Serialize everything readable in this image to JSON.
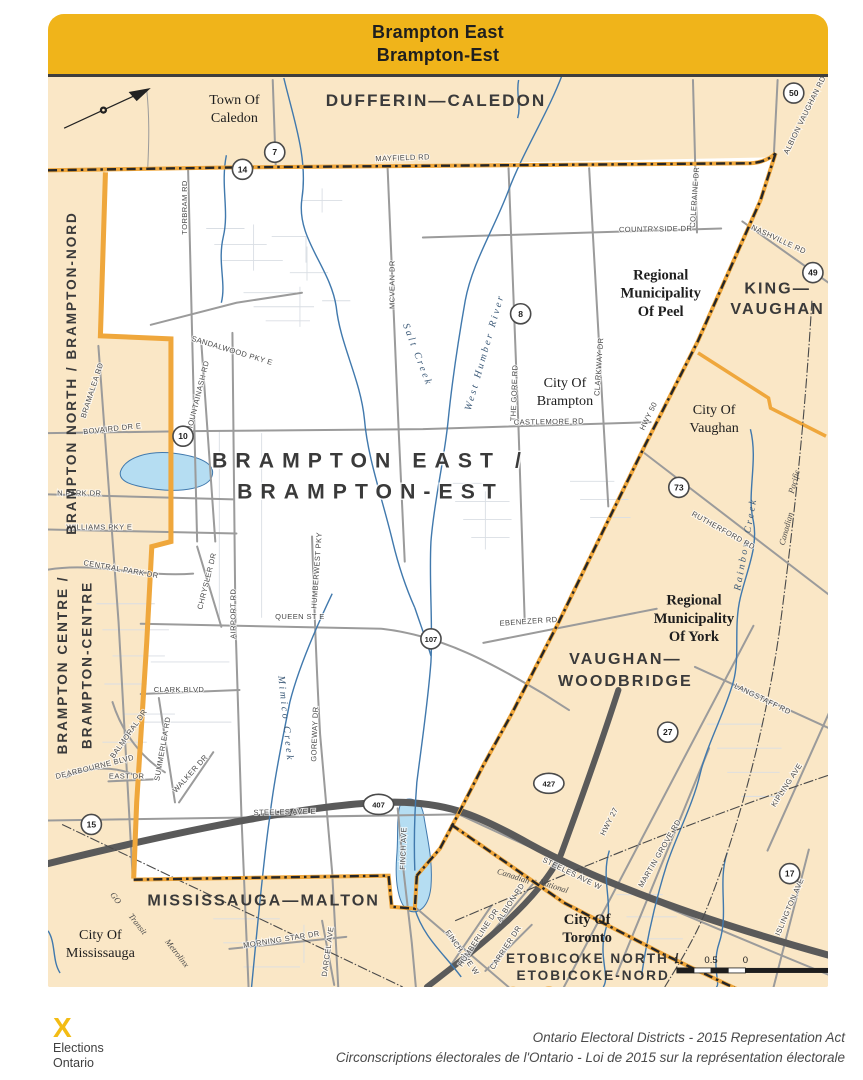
{
  "banner": {
    "line1": "Brampton East",
    "line2": "Brampton-Est"
  },
  "colors": {
    "banner_gold": "#F0B41A",
    "district_fill": "#FFFFFF",
    "neighbor_fill": "#FAE7C6",
    "boundary_yellow": "#EFA73C",
    "boundary_dash": "#262626",
    "water_blue": "#4179AD",
    "lake_fill": "#B5DDF2",
    "highway_gray": "#5A5A5A",
    "road_gray": "#9B9B9B"
  },
  "labels": {
    "central_district": [
      {
        "t": "BRAMPTON EAST /",
        "x": 368,
        "y": 466
      },
      {
        "t": "BRAMPTON-EST",
        "x": 368,
        "y": 497
      }
    ],
    "adjacent_districts": [
      {
        "t": "DUFFERIN—CALEDON",
        "x": 433,
        "y": 106,
        "s": 17
      },
      {
        "t": "KING—",
        "x": 772,
        "y": 293,
        "s": 16
      },
      {
        "t": "VAUGHAN",
        "x": 772,
        "y": 313,
        "s": 16
      },
      {
        "t": "VAUGHAN—",
        "x": 621,
        "y": 662,
        "s": 16
      },
      {
        "t": "WOODBRIDGE",
        "x": 621,
        "y": 684,
        "s": 16
      },
      {
        "t": "MISSISSAUGA—MALTON",
        "x": 262,
        "y": 903,
        "s": 16
      },
      {
        "t": "ETOBICOKE NORTH /",
        "x": 589,
        "y": 960,
        "s": 13.5
      },
      {
        "t": "ETOBICOKE-NORD",
        "x": 589,
        "y": 977,
        "s": 13.5
      },
      {
        "t": "BRAMPTON NORTH / BRAMPTON-NORD",
        "x": 76,
        "y": 372,
        "r": -90,
        "s": 13.5
      },
      {
        "t": "BRAMPTON CENTRE /",
        "x": 67,
        "y": 663,
        "r": -90,
        "s": 13.5
      },
      {
        "t": "BRAMPTON-CENTRE",
        "x": 91,
        "y": 663,
        "r": -90,
        "s": 13.5
      }
    ],
    "municipalities": [
      {
        "t": "Town Of",
        "x": 233,
        "y": 104
      },
      {
        "t": "Caledon",
        "x": 233,
        "y": 122
      },
      {
        "t": "Regional",
        "x": 656,
        "y": 279,
        "b": 1
      },
      {
        "t": "Municipality",
        "x": 656,
        "y": 297,
        "b": 1
      },
      {
        "t": "Of Peel",
        "x": 656,
        "y": 315,
        "b": 1
      },
      {
        "t": "City Of",
        "x": 561,
        "y": 386
      },
      {
        "t": "Brampton",
        "x": 561,
        "y": 404
      },
      {
        "t": "City Of",
        "x": 709,
        "y": 413
      },
      {
        "t": "Vaughan",
        "x": 709,
        "y": 431
      },
      {
        "t": "Regional",
        "x": 689,
        "y": 603,
        "b": 1
      },
      {
        "t": "Municipality",
        "x": 689,
        "y": 621,
        "b": 1
      },
      {
        "t": "Of York",
        "x": 689,
        "y": 639,
        "b": 1
      },
      {
        "t": "City Of",
        "x": 583,
        "y": 921,
        "b": 1
      },
      {
        "t": "Toronto",
        "x": 583,
        "y": 939,
        "b": 1
      },
      {
        "t": "City Of",
        "x": 100,
        "y": 936
      },
      {
        "t": "Mississauga",
        "x": 100,
        "y": 954
      }
    ],
    "roads": [
      {
        "t": "MAYFIELD RD",
        "x": 400,
        "y": 160,
        "r": -2
      },
      {
        "t": "TORBRAM RD",
        "x": 186,
        "y": 207,
        "r": -90
      },
      {
        "t": "SANDALWOOD PKY E",
        "x": 230,
        "y": 352,
        "r": 17
      },
      {
        "t": "MOUNTAINASH RD",
        "x": 199,
        "y": 396,
        "r": -76
      },
      {
        "t": "BRAMALEA RD",
        "x": 94,
        "y": 390,
        "r": -72
      },
      {
        "t": "BOVAIRD DR E",
        "x": 112,
        "y": 430,
        "r": -6
      },
      {
        "t": "N PARK DR",
        "x": 79,
        "y": 494
      },
      {
        "t": "WILLIAMS PKY E",
        "x": 99,
        "y": 528
      },
      {
        "t": "CENTRAL PARK DR",
        "x": 120,
        "y": 570,
        "r": 10
      },
      {
        "t": "CHRYSLER DR",
        "x": 208,
        "y": 580,
        "r": -76
      },
      {
        "t": "CLARK BLVD",
        "x": 178,
        "y": 690
      },
      {
        "t": "SUMMERLEA RD",
        "x": 164,
        "y": 747,
        "r": -80
      },
      {
        "t": "WALKER DR",
        "x": 191,
        "y": 773,
        "r": -48
      },
      {
        "t": "BALMORAL DR",
        "x": 130,
        "y": 733,
        "r": -55
      },
      {
        "t": "DEARBOURNE BLVD",
        "x": 95,
        "y": 767,
        "r": -14
      },
      {
        "t": "EAST DR",
        "x": 126,
        "y": 776
      },
      {
        "t": "MCVEAN DR",
        "x": 392,
        "y": 284,
        "r": -90
      },
      {
        "t": "THE GORE RD",
        "x": 513,
        "y": 392,
        "r": -88
      },
      {
        "t": "CLARKWAY DR",
        "x": 597,
        "y": 366,
        "r": -86
      },
      {
        "t": "COLERAINE DR",
        "x": 692,
        "y": 197,
        "r": -86
      },
      {
        "t": "COUNTRYSIDE DR",
        "x": 651,
        "y": 231,
        "r": -1
      },
      {
        "t": "CASTLEMORE RD",
        "x": 545,
        "y": 423,
        "r": -1
      },
      {
        "t": "QUEEN ST E",
        "x": 298,
        "y": 617
      },
      {
        "t": "EBENEZER RD",
        "x": 525,
        "y": 622,
        "r": -4
      },
      {
        "t": "HUMBERWEST PKY",
        "x": 317,
        "y": 569,
        "r": -86
      },
      {
        "t": "GOREWAY DR",
        "x": 315,
        "y": 732,
        "r": -88
      },
      {
        "t": "AIRPORT RD",
        "x": 234,
        "y": 612,
        "r": -90
      },
      {
        "t": "STEELES AVE E",
        "x": 283,
        "y": 812,
        "r": -1
      },
      {
        "t": "FINCH AVE",
        "x": 403,
        "y": 846,
        "r": -88
      },
      {
        "t": "NASHVILLE RD",
        "x": 772,
        "y": 241,
        "r": 25
      },
      {
        "t": "ALBION VAUGHAN RD",
        "x": 801,
        "y": 116,
        "r": -64
      },
      {
        "t": "HWY 50",
        "x": 646,
        "y": 416,
        "r": -64
      },
      {
        "t": "RUTHERFORD RD",
        "x": 717,
        "y": 531,
        "r": 29
      },
      {
        "t": "LANGSTAFF RD",
        "x": 756,
        "y": 699,
        "r": 26
      },
      {
        "t": "HWY 27",
        "x": 607,
        "y": 820,
        "r": -63
      },
      {
        "t": "KIPLING AVE",
        "x": 783,
        "y": 784,
        "r": -57
      },
      {
        "t": "MARTIN GROVE RD",
        "x": 657,
        "y": 852,
        "r": -60
      },
      {
        "t": "ISLINGTON AVE",
        "x": 786,
        "y": 905,
        "r": -67
      },
      {
        "t": "STEELES AVE W",
        "x": 567,
        "y": 873,
        "r": 26
      },
      {
        "t": "FINCH AVE W",
        "x": 457,
        "y": 951,
        "r": 55
      },
      {
        "t": "MORNING STAR DR",
        "x": 280,
        "y": 939,
        "r": -9
      },
      {
        "t": "DARCEL AVE",
        "x": 328,
        "y": 949,
        "r": -82
      },
      {
        "t": "HUMBERLINE DR",
        "x": 477,
        "y": 936,
        "r": -57
      },
      {
        "t": "ALBION RD",
        "x": 509,
        "y": 901,
        "r": -57
      },
      {
        "t": "CARRIER DR",
        "x": 504,
        "y": 946,
        "r": -57
      }
    ],
    "waterways": [
      {
        "t": "Salt Creek",
        "x": 412,
        "y": 355,
        "r": 69
      },
      {
        "t": "West Humber River",
        "x": 484,
        "y": 352,
        "r": -74
      },
      {
        "t": "Mimico Creek",
        "x": 281,
        "y": 717,
        "r": 84
      },
      {
        "t": "Rainbow Creek",
        "x": 743,
        "y": 543,
        "r": -80
      }
    ],
    "railways": [
      {
        "t": "GO",
        "x": 113,
        "y": 897,
        "r": 52
      },
      {
        "t": "Transit",
        "x": 135,
        "y": 923,
        "r": 52
      },
      {
        "t": "Metrolinx",
        "x": 174,
        "y": 952,
        "r": 52
      },
      {
        "t": "Canadian",
        "x": 509,
        "y": 876,
        "r": 18
      },
      {
        "t": "National",
        "x": 549,
        "y": 886,
        "r": 18
      },
      {
        "t": "Pacific",
        "x": 791,
        "y": 481,
        "r": -75
      },
      {
        "t": "Canadian",
        "x": 783,
        "y": 528,
        "r": -75
      }
    ]
  },
  "shields": [
    {
      "n": "7",
      "x": 273,
      "y": 152
    },
    {
      "n": "14",
      "x": 241,
      "y": 169
    },
    {
      "n": "50",
      "x": 788,
      "y": 93
    },
    {
      "n": "49",
      "x": 807,
      "y": 272
    },
    {
      "n": "8",
      "x": 517,
      "y": 313
    },
    {
      "n": "10",
      "x": 182,
      "y": 435
    },
    {
      "n": "73",
      "x": 674,
      "y": 486
    },
    {
      "n": "107",
      "x": 428,
      "y": 637
    },
    {
      "n": "27",
      "x": 663,
      "y": 730
    },
    {
      "n": "15",
      "x": 91,
      "y": 822
    },
    {
      "n": "17",
      "x": 784,
      "y": 871
    },
    {
      "n": "427",
      "x": 545,
      "y": 781,
      "oval": true
    },
    {
      "n": "407",
      "x": 376,
      "y": 802,
      "oval": true
    }
  ],
  "scale_bar": {
    "ticks": [
      {
        "t": "1",
        "x": 672
      },
      {
        "t": "0.5",
        "x": 706
      },
      {
        "t": "0",
        "x": 740
      },
      {
        "t": "1",
        "x": 838
      }
    ],
    "unit": "km",
    "unit_x": 847,
    "bar": {
      "x": 672,
      "w": 166,
      "y": 965,
      "h": 5,
      "break_x": 740
    }
  },
  "footer": {
    "logo_mark": "X",
    "org_line1": "Elections",
    "org_line2": "Ontario",
    "credit_en": "Ontario Electoral Districts - 2015 Representation Act",
    "credit_fr": "Circonscriptions électorales de l'Ontario - Loi de 2015 sur la représentation électorale"
  }
}
